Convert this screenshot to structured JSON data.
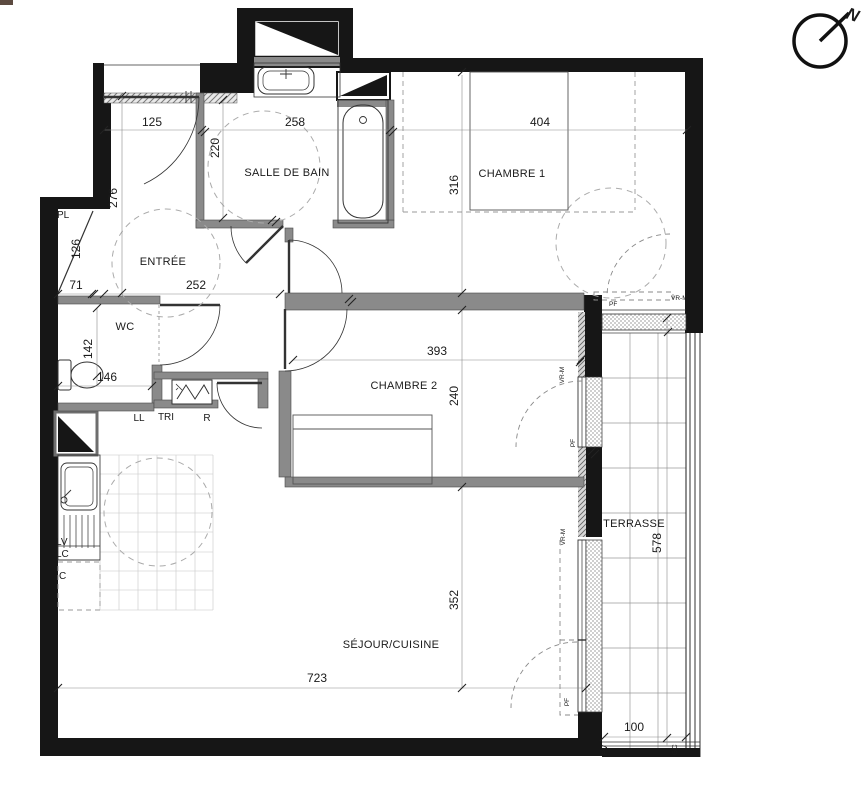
{
  "compass": {
    "north": "N"
  },
  "rooms": {
    "bathroom": "SALLE DE BAIN",
    "entry": "ENTRÉE",
    "bedroom1": "CHAMBRE 1",
    "bedroom2": "CHAMBRE 2",
    "wc": "WC",
    "living": "SÉJOUR/CUISINE",
    "terrace": "TERRASSE",
    "closet": "PL"
  },
  "dimensions_cm": {
    "entry_door": "125",
    "bathroom_width": "258",
    "bathroom_depth": "220",
    "bedroom1_width": "404",
    "bedroom1_depth": "316",
    "entry_left_depth": "276",
    "closet_diagonal": "126",
    "closet_width": "71",
    "entry_width": "252",
    "wc_depth": "142",
    "wc_width": "146",
    "bedroom2_width": "393",
    "bedroom2_depth": "240",
    "living_depth": "352",
    "living_width": "723",
    "terrace_depth": "578",
    "terrace_width": "100"
  },
  "appliances": {
    "washing_machine": "LL",
    "sorting_bin": "TRI",
    "fridge": "R",
    "dishwasher": "LV",
    "lc": "LC",
    "cooker": "C"
  },
  "openings": {
    "french_window": "PF",
    "roller_shutter": "VR-M",
    "pv": "PV",
    "gc": "GC"
  },
  "colors": {
    "wall_black": "#161616",
    "wall_gray": "#8a8a8a",
    "line": "#333333",
    "dashed": "#9a9a9a"
  }
}
